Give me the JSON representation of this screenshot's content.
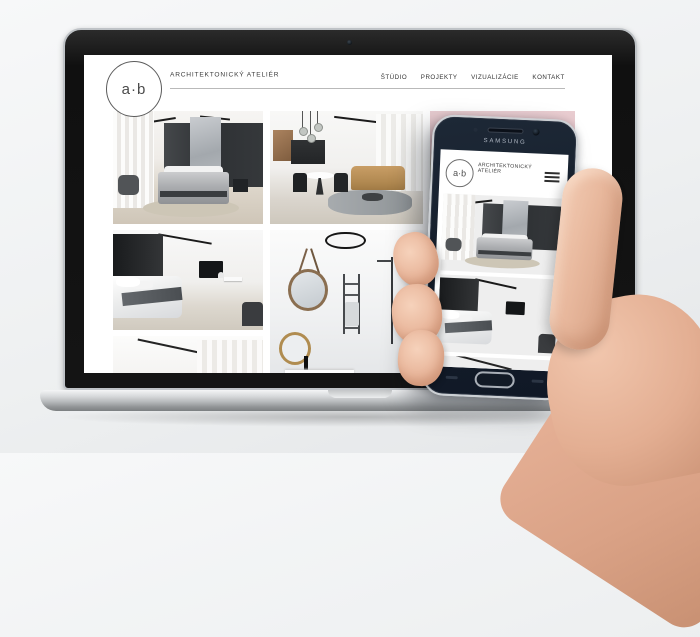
{
  "desktop_site": {
    "logo_text": "a·b",
    "brand_name": "ARCHITEKTONICKÝ ATELIÉR",
    "nav_items": [
      {
        "label": "ŠTÚDIO"
      },
      {
        "label": "PROJEKTY"
      },
      {
        "label": "VIZUALIZÁCIE"
      },
      {
        "label": "KONTAKT"
      }
    ],
    "gallery": [
      {
        "name": "bedroom-grey-marble"
      },
      {
        "name": "living-room-kitchen"
      },
      {
        "name": "pink-wall-plants"
      },
      {
        "name": "bedroom-white-tv"
      },
      {
        "name": "bathroom-round-mirror"
      },
      {
        "name": "hidden-behind-phone"
      },
      {
        "name": "white-room-curtains"
      }
    ]
  },
  "mobile_site": {
    "device_brand": "SAMSUNG",
    "logo_text": "a·b",
    "brand_line1": "ARCHITEKTONICKÝ",
    "brand_line2": "ATELIÉR",
    "gallery": [
      {
        "name": "bedroom-grey-marble"
      },
      {
        "name": "bedroom-white-tv"
      },
      {
        "name": "white-room-partial"
      }
    ]
  },
  "colors": {
    "background": "#eef0f1",
    "phone_body": "#141d2a",
    "laptop_base_silver": "#b8bbbd",
    "accent_pink": "#e2c2c7",
    "plant_green": "#4f5e47",
    "sofa_mustard": "#c99e66",
    "skin_tone": "#e9b79c"
  }
}
